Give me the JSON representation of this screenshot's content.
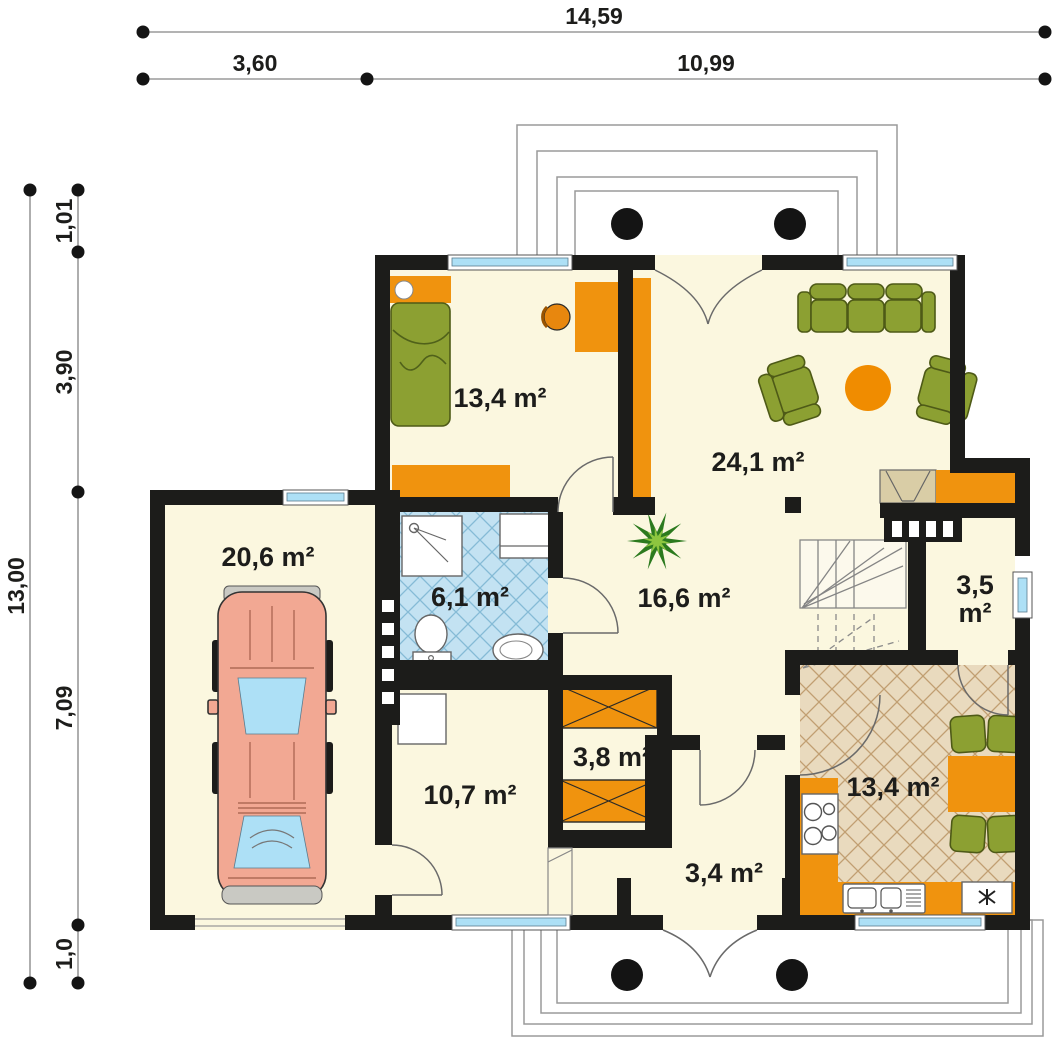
{
  "dimensions": {
    "total_width": "14,59",
    "left_width": "3,60",
    "right_width": "10,99",
    "total_depth": "13,00",
    "porch_depth": "1,01",
    "top_depth": "3,90",
    "middle_depth": "7,09",
    "bottom_depth": "1,0"
  },
  "rooms": {
    "bedroom": {
      "area": "13,4 m²"
    },
    "living_room": {
      "area": "24,1 m²"
    },
    "garage": {
      "area": "20,6 m²"
    },
    "bathroom": {
      "area": "6,1 m²"
    },
    "hall": {
      "area": "16,6 m²"
    },
    "pantry": {
      "area_value": "3,5",
      "area_unit": "m²"
    },
    "wardrobe": {
      "area": "3,8 m²"
    },
    "utility_room": {
      "area": "10,7 m²"
    },
    "vestibule": {
      "area": "3,4 m²"
    },
    "kitchen": {
      "area": "13,4 m²"
    }
  },
  "colors": {
    "wall": "#1c1c1a",
    "floor": "#FBF7DF",
    "accentOrange": "#F0930E",
    "furnitureGreen": "#8CA032",
    "glassBlue": "#ADE0F6",
    "bathTile": "#C3E2F2",
    "kitchenTile": "#E9DABE",
    "carBody": "#F2A893",
    "dimension": "#1d1d1b"
  },
  "furniture": [
    {
      "name": "double-bed"
    },
    {
      "name": "desk"
    },
    {
      "name": "desk-chair"
    },
    {
      "name": "wardrobe-cabinet"
    },
    {
      "name": "sofa"
    },
    {
      "name": "armchair"
    },
    {
      "name": "coffee-table"
    },
    {
      "name": "tv-sideboard"
    },
    {
      "name": "potted-plant"
    },
    {
      "name": "car"
    },
    {
      "name": "shower"
    },
    {
      "name": "washbasin"
    },
    {
      "name": "toilet"
    },
    {
      "name": "bidet"
    },
    {
      "name": "washing-machine"
    },
    {
      "name": "cooktop"
    },
    {
      "name": "kitchen-sink"
    },
    {
      "name": "fridge"
    },
    {
      "name": "dining-table"
    },
    {
      "name": "dining-chair"
    },
    {
      "name": "staircase"
    },
    {
      "name": "porch-column"
    }
  ]
}
